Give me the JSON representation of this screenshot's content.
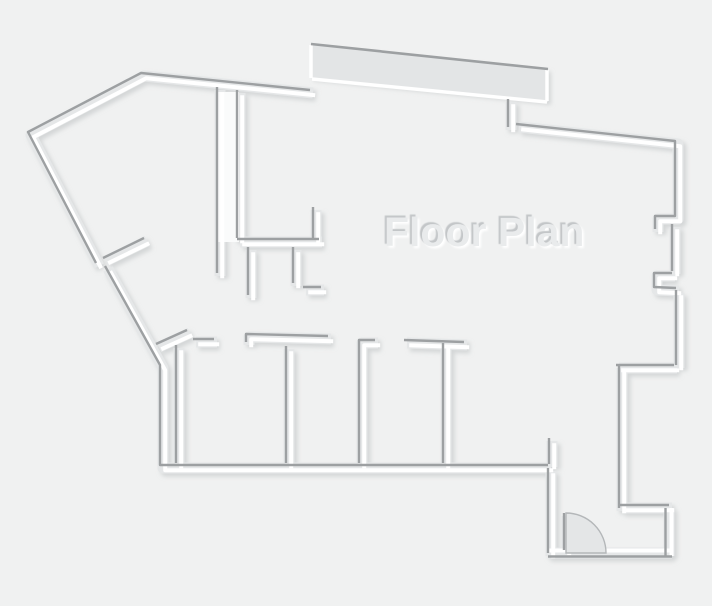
{
  "title": {
    "text": "Floor Plan",
    "x": 384,
    "y": 209,
    "font_size": 41,
    "fill": "#e9ebec",
    "shadow_dark": "#c3c6c8",
    "shadow_light": "#ffffff"
  },
  "canvas": {
    "width": 712,
    "height": 606,
    "background": "#f0f1f1"
  },
  "floor_plan": {
    "wall_style": {
      "base_color": "#e5e7e8",
      "base_width": 11,
      "highlight_color": "#ffffff",
      "highlight_width": 4,
      "crest_color": "#9da0a2",
      "crest_width": 2.4,
      "default_crest_offset": [
        -3,
        -3
      ],
      "default_highlight_offset": [
        2.2,
        2.2
      ]
    },
    "shadow": {
      "dx": 3,
      "dy": 3,
      "blur": 2,
      "color": "#b8bbbd",
      "opacity": 0.5
    },
    "band": {
      "polygon": [
        [
          311,
          44
        ],
        [
          548,
          69
        ],
        [
          548,
          102
        ],
        [
          311,
          78
        ]
      ],
      "fill": "#e3e5e6",
      "crest": [
        [
          311,
          44
        ],
        [
          548,
          69
        ]
      ],
      "white_edges": [
        [
          [
            311,
            45
          ],
          [
            311,
            78
          ]
        ],
        [
          [
            312,
            79
          ],
          [
            547,
            102
          ]
        ],
        [
          [
            547,
            70
          ],
          [
            547,
            101
          ]
        ]
      ]
    },
    "double_wall_fill": {
      "x": 217,
      "y": 92,
      "width": 22,
      "height": 150,
      "color": "#fafbfb"
    },
    "walls": [
      {
        "name": "outer-wall-upper-left",
        "points": [
          [
            99,
            266
          ],
          [
            31,
            135
          ],
          [
            144,
            76
          ],
          [
            313,
            93
          ]
        ]
      },
      {
        "name": "outer-wall-lower-left-and-bottom",
        "points": [
          [
            108,
            269
          ],
          [
            163,
            368
          ],
          [
            163,
            468
          ],
          [
            551,
            468
          ]
        ]
      },
      {
        "name": "bottom-wall-stub",
        "points": [
          [
            552,
            441
          ],
          [
            552,
            467
          ]
        ]
      },
      {
        "name": "outer-wall-entry-left",
        "points": [
          [
            551,
            471
          ],
          [
            551,
            556
          ]
        ]
      },
      {
        "name": "outer-wall-entry-bottom",
        "points": [
          [
            548,
            553
          ],
          [
            672,
            553
          ]
        ],
        "co": [
          0,
          3.5
        ],
        "ho": [
          0,
          -2.5
        ]
      },
      {
        "name": "outer-wall-entry-right",
        "points": [
          [
            669,
            556
          ],
          [
            669,
            508
          ]
        ],
        "co": [
          -3.5,
          0
        ],
        "ho": [
          2.5,
          0
        ]
      },
      {
        "name": "outer-wall-jog-top",
        "points": [
          [
            672,
            508
          ],
          [
            622,
            508
          ]
        ]
      },
      {
        "name": "inner-right-wall",
        "points": [
          [
            622,
            511
          ],
          [
            622,
            368
          ]
        ]
      },
      {
        "name": "right-wing-bottom-wall",
        "points": [
          [
            619,
            368
          ],
          [
            677,
            368
          ]
        ]
      },
      {
        "name": "top-right-wall-and-upper-right-wall",
        "points": [
          [
            519,
            127
          ],
          [
            678,
            144
          ],
          [
            678,
            219
          ],
          [
            658,
            219
          ],
          [
            658,
            232
          ]
        ]
      },
      {
        "name": "right-wall-mid-segment",
        "points": [
          [
            675,
            227
          ],
          [
            675,
            274
          ]
        ]
      },
      {
        "name": "right-wall-notch",
        "points": [
          [
            675,
            276
          ],
          [
            657,
            276
          ],
          [
            657,
            290
          ],
          [
            679,
            291
          ]
        ]
      },
      {
        "name": "right-wall-lower",
        "points": [
          [
            679,
            293
          ],
          [
            679,
            368
          ]
        ]
      },
      {
        "name": "band-notch-wall",
        "points": [
          [
            511,
            102
          ],
          [
            511,
            130
          ]
        ]
      },
      {
        "name": "hall-wall-left",
        "points": [
          [
            220,
            90
          ],
          [
            220,
            276
          ]
        ]
      },
      {
        "name": "hall-wall-right",
        "points": [
          [
            240,
            93
          ],
          [
            240,
            241
          ]
        ]
      },
      {
        "name": "closet-top-wall",
        "points": [
          [
            240,
            242
          ],
          [
            322,
            242
          ]
        ]
      },
      {
        "name": "closet-stub-right",
        "points": [
          [
            316,
            210
          ],
          [
            316,
            242
          ]
        ]
      },
      {
        "name": "closet-divider-left",
        "points": [
          [
            251,
            250
          ],
          [
            251,
            298
          ]
        ]
      },
      {
        "name": "closet-divider-right",
        "points": [
          [
            296,
            250
          ],
          [
            296,
            286
          ]
        ]
      },
      {
        "name": "closet-tick",
        "points": [
          [
            306,
            290
          ],
          [
            324,
            290
          ]
        ]
      },
      {
        "name": "diagonal-door-stub-upper",
        "points": [
          [
            106,
            261
          ],
          [
            147,
            241
          ]
        ]
      },
      {
        "name": "diagonal-door-stub-lower",
        "points": [
          [
            159,
            347
          ],
          [
            190,
            333
          ]
        ]
      },
      {
        "name": "room-top-dash",
        "points": [
          [
            196,
            342
          ],
          [
            217,
            342
          ]
        ]
      },
      {
        "name": "rooms-top-wall",
        "points": [
          [
            249,
            345
          ],
          [
            249,
            337
          ],
          [
            331,
            339
          ]
        ]
      },
      {
        "name": "room-left-wall",
        "points": [
          [
            179,
            348
          ],
          [
            179,
            466
          ]
        ]
      },
      {
        "name": "room-divider-1",
        "points": [
          [
            289,
            349
          ],
          [
            289,
            466
          ]
        ]
      },
      {
        "name": "room-divider-2",
        "points": [
          [
            378,
            343
          ],
          [
            362,
            343
          ],
          [
            362,
            466
          ]
        ]
      },
      {
        "name": "room-divider-3-top",
        "points": [
          [
            407,
            343
          ],
          [
            467,
            345
          ]
        ]
      },
      {
        "name": "room-divider-3",
        "points": [
          [
            446,
            346
          ],
          [
            446,
            466
          ]
        ]
      },
      {
        "name": "door-jamb",
        "points": [
          [
            567,
            516
          ],
          [
            567,
            553
          ]
        ]
      }
    ],
    "door": {
      "cx": 566,
      "cy": 553,
      "r": 40,
      "fill": "#e4e6e7",
      "stroke": "#b4b7b9",
      "stroke_width": 1.4
    }
  }
}
